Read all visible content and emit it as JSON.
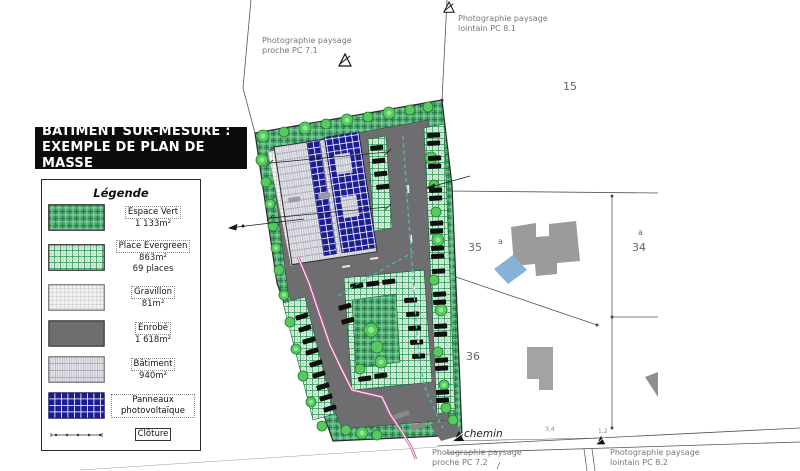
{
  "title": {
    "line1": "BÂTIMENT SUR-MESURE :",
    "line2": "EXEMPLE DE PLAN DE MASSE"
  },
  "legend": {
    "title": "Légende",
    "items": [
      {
        "key": "espace-vert",
        "label": "Espace Vert",
        "lines": [
          "1 133m²"
        ]
      },
      {
        "key": "place-evergreen",
        "label": "Place Evergreen",
        "lines": [
          "863m²",
          "69 places"
        ]
      },
      {
        "key": "gravillon",
        "label": "Gravillon",
        "lines": [
          "81m²"
        ]
      },
      {
        "key": "enrobe",
        "label": "Enrobé",
        "lines": [
          "1 618m²"
        ]
      },
      {
        "key": "batiment",
        "label": "Bâtiment",
        "lines": [
          "940m²"
        ]
      },
      {
        "key": "panneaux",
        "label": "Panneaux photovoltaïque",
        "lines": []
      },
      {
        "key": "cloture",
        "label": "Clôture",
        "lines": []
      }
    ]
  },
  "annotations": {
    "pc71": {
      "line1": "Photographie paysage",
      "line2": "proche PC 7.1"
    },
    "pc81": {
      "line1": "Photographie paysage",
      "line2": "lointain PC 8.1"
    },
    "pc72": {
      "line1": "Photographie paysage",
      "line2": "proche PC 7.2"
    },
    "pc82": {
      "line1": "Photographie paysage",
      "line2": "lointain PC 8.2"
    }
  },
  "parcels": {
    "p15": "15",
    "p35": "35",
    "a35": "a",
    "a34": "a",
    "p34": "34",
    "p36": "36"
  },
  "road": {
    "chemin": "chemin",
    "dim1": "3,4",
    "dim2": "1,2"
  },
  "colors": {
    "espace_vert": "#4aa86e",
    "espace_vert_dark": "#2a7d4c",
    "espace_vert_light": "#8fd7a6",
    "place_evergreen": "#d9efdf",
    "evergreen_line": "#4aa36a",
    "gravillon": "#f2f2f2",
    "enrobe": "#6e6e70",
    "batiment": "#e3e3e9",
    "panneaux": "#1d1d93",
    "tree": "#57c95e",
    "tree_light": "#8ee88f",
    "path_pink": "#c75d9b",
    "path_teal": "#53b8b2",
    "pool": "#85b2d6",
    "neighbor_gray": "#9b9b9b"
  }
}
